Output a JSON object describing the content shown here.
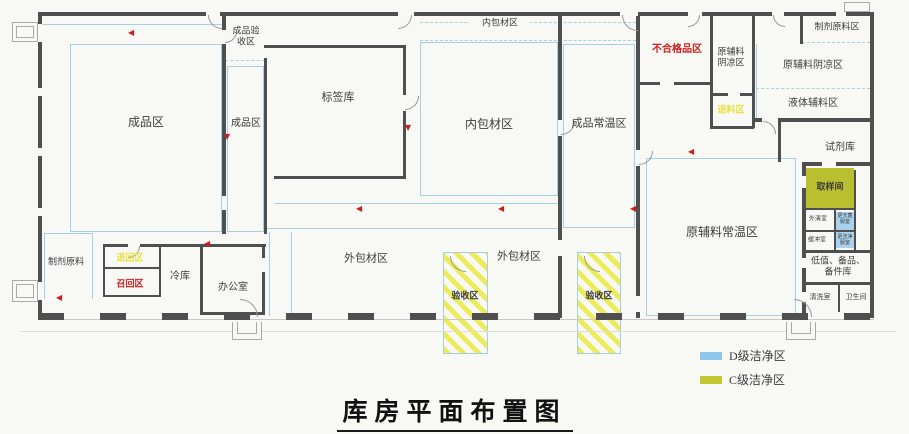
{
  "title": "库房平面布置图",
  "legend": [
    {
      "label": "D级洁净区",
      "color": "#8ec7ea"
    },
    {
      "label": "C级洁净区",
      "color": "#c3c832"
    }
  ],
  "colors": {
    "wall": "#4f4f4f",
    "clean_line": "#a6cfe3",
    "d_grade_fill": "#a9d2ee",
    "c_grade_fill": "#b9bf2f",
    "hatch_stripe": "#ecec5a",
    "red_label": "#cc2020",
    "yellow_label": "#e6e242",
    "text": "#3c3c3c"
  },
  "rooms": {
    "chengpin_qu": "成品区",
    "chengpin_yanshou_qu": "成品验收区",
    "chengpin_qu_2": "成品区",
    "biaoqian_ku": "标签库",
    "neibaocai_corridor": "内包材区",
    "neibaocai_qu": "内包材区",
    "chengpin_changwen_qu": "成品常温区",
    "buhegepin_qu": "不合格品区",
    "yuanfuliao_yinliang_xiao": "原辅料阴凉区",
    "tuiliao_qu": "退料区",
    "zhiji_yuanliao_qu": "制剂原料区",
    "yuanfuliao_yinliang_qu": "原辅料阴凉区",
    "yeti_fuliao_qu": "液体辅料区",
    "shiji_ku": "试剂库",
    "quyang_jian": "取样间",
    "waiqing_shi": "外清室",
    "geng_wujun_fu_shi": "更无菌服室",
    "huanchong_shi": "缓冲室",
    "geng_jiejing_fu_shi": "更洁净服室",
    "dizhi_beipin_ku": "低值、备品、备件库",
    "qingxi_shi": "清洗室",
    "weisheng_jian": "卫生间",
    "yuanfuliao_changwen_qu": "原辅料常温区",
    "waibaocai_qu_1": "外包材区",
    "yanshou_qu_1": "验收区",
    "waibaocai_qu_2": "外包材区",
    "yanshou_qu_2": "验收区",
    "zhiji_yuanliao": "制剂原料",
    "tuihui_qu": "退回区",
    "zhaohui_qu": "召回区",
    "leng_ku": "冷库",
    "bangong_shi": "办公室"
  }
}
